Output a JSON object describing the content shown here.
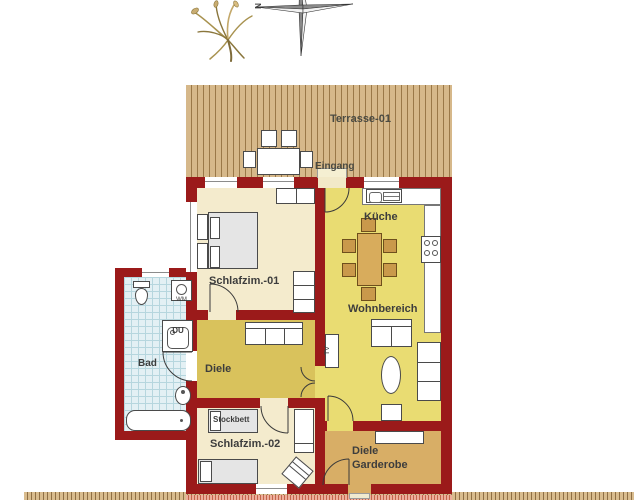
{
  "plan": {
    "type": "apartment-floor-plan",
    "compass": {
      "north": "N"
    },
    "labels": {
      "terrace": "Terrasse-01",
      "entrance": "Eingang",
      "bedroom1": "Schlafzim.-01",
      "kitchen": "Küche",
      "living": "Wohnbereich",
      "hallway": "Diele",
      "bathroom": "Bad",
      "shower": "DU",
      "washing_machine": "WM",
      "tv": "TV",
      "bunk_bed": "Stockbett",
      "bedroom2": "Schlafzim.-02",
      "entry_hall_line1": "Diele",
      "entry_hall_line2": "Garderobe"
    },
    "colors": {
      "wall": "#9B1A1A",
      "terrace_deck": "#D6B88A",
      "bedroom_floor": "#F4EBCD",
      "kitchen_living_floor": "#E9DC72",
      "hallway_floor": "#D9C25C",
      "entry_hall_floor": "#D8AE66",
      "bathroom_tile": "#E3F0F4",
      "furniture_wood": "#C9994B"
    }
  }
}
